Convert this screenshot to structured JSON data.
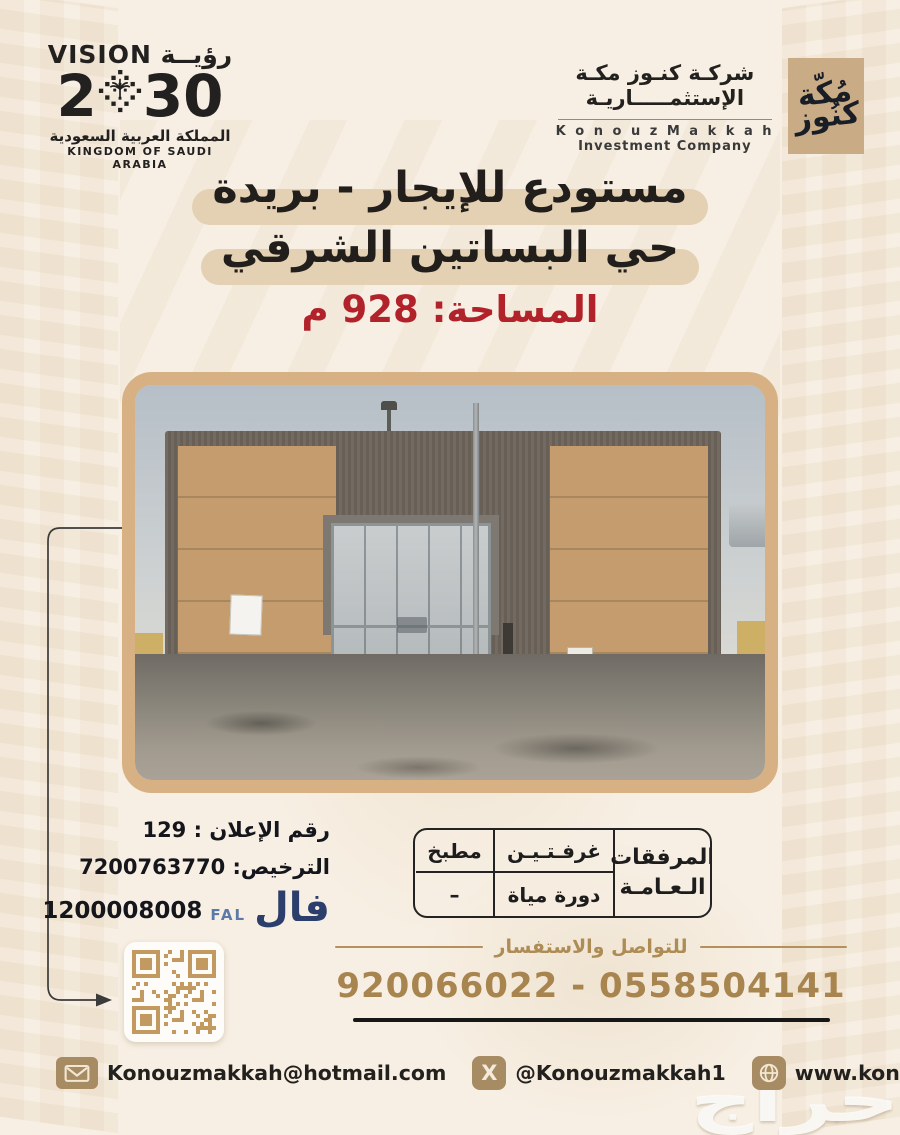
{
  "colors": {
    "red": "#b2222a",
    "gold": "#a8854f",
    "navy": "#2c3e6b",
    "pill": "#e4d1b3",
    "icon_tan": "#a68b63",
    "frame_tan": "#d7b084"
  },
  "vision_logo": {
    "wordmark": "رؤيــة VISION",
    "year_prefix": "2",
    "year_suffix": "30",
    "country_ar": "المملكة العربية السعودية",
    "country_en": "KINGDOM OF SAUDI ARABIA"
  },
  "company": {
    "name_ar_line1": "شركـة كنـوز مكـة",
    "name_ar_line2": "الإستثمـــــاريـة",
    "name_en_line1": "K o n o u z   M a k k a h",
    "name_en_line2": "Investment Company",
    "mark_word1": "مُكّة",
    "mark_word2": "كنُوز"
  },
  "listing": {
    "title_line1": "مستودع للإيجار - بريدة",
    "title_line2": "حي البساتين الشرقي",
    "area": "المساحة: 928 م"
  },
  "ad_info": {
    "ad_number": "رقم الإعلان : 129",
    "license": "الترخيص: 7200763770",
    "fal_number": "1200008008",
    "fal_en": "FAL",
    "fal_ar": "فال"
  },
  "facilities": {
    "header_line1": "المرفقات",
    "header_line2": "الـعـامـة",
    "rows": [
      [
        "غرفـتـيـن",
        "مطبخ"
      ],
      [
        "دورة مياة",
        "–"
      ]
    ]
  },
  "contact": {
    "heading": "للتواصل والاستفسار",
    "phones": "920066022 - 0558504141"
  },
  "footer": {
    "email": "Konouzmakkah@hotmail.com",
    "x_handle": "@Konouzmakkah1",
    "website": "www.konouzmakkah.com"
  },
  "watermark": "حراج"
}
